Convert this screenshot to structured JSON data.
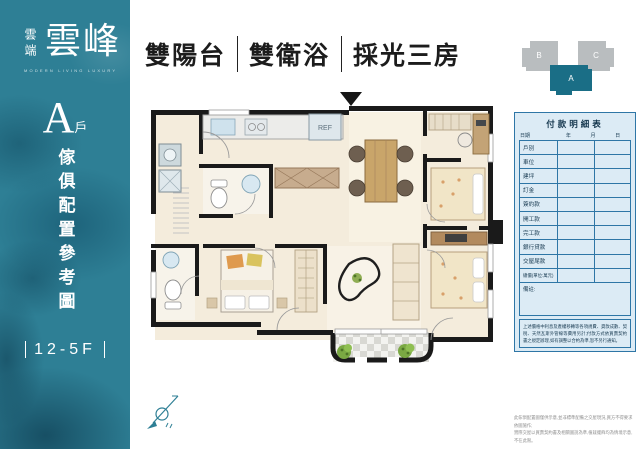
{
  "colors": {
    "teal": "#2e7f95",
    "table_border": "#2e76a6",
    "table_bg": "#dcebf5",
    "table_text": "#16384f",
    "keyplan_gray": "#b9bdbf",
    "keyplan_teal": "#1a6e86",
    "wall": "#1a1a1a"
  },
  "brand": {
    "name_small": "雲端",
    "name_large": "雲峰",
    "subtext": "MODERN  LIVING  LUXURY"
  },
  "unit": {
    "letter": "A",
    "suffix": "戶",
    "caption": "傢俱配置參考圖",
    "floors": "12-5F"
  },
  "headline": {
    "items": [
      "雙陽台",
      "雙衛浴",
      "採光三房"
    ]
  },
  "keyplan": {
    "blocks": [
      {
        "label": "B"
      },
      {
        "label": "C"
      },
      {
        "label": "A"
      }
    ]
  },
  "plan": {
    "fridge_label": "REF"
  },
  "payment_table": {
    "title": "付款明細表",
    "date_label": "日期",
    "date_cols": [
      "年",
      "月",
      "日"
    ],
    "rows": [
      "戶別",
      "車位",
      "建坪",
      "訂金",
      "簽約款",
      "開工款",
      "完工款",
      "銀行貸款",
      "交屋尾款",
      "總價(單位:萬元)"
    ],
    "remark_label": "備註:",
    "note": "上述價格中利息及產權移轉等各項規費、貸款成數、契稅、天然瓦斯外管線等費用另計;付款方式依買賣契約書之規定辦理,如有調整以合約為準,恕不另行通知。"
  },
  "footer": {
    "line1": "此傢俱配置圖僅供示意,並非標準配備之交屋現況,買方不得要求依圖施作;",
    "line2": "實際交屋以買賣契約書及相關圖說為準,植栽擺飾均為情境示意,不在此限。"
  }
}
